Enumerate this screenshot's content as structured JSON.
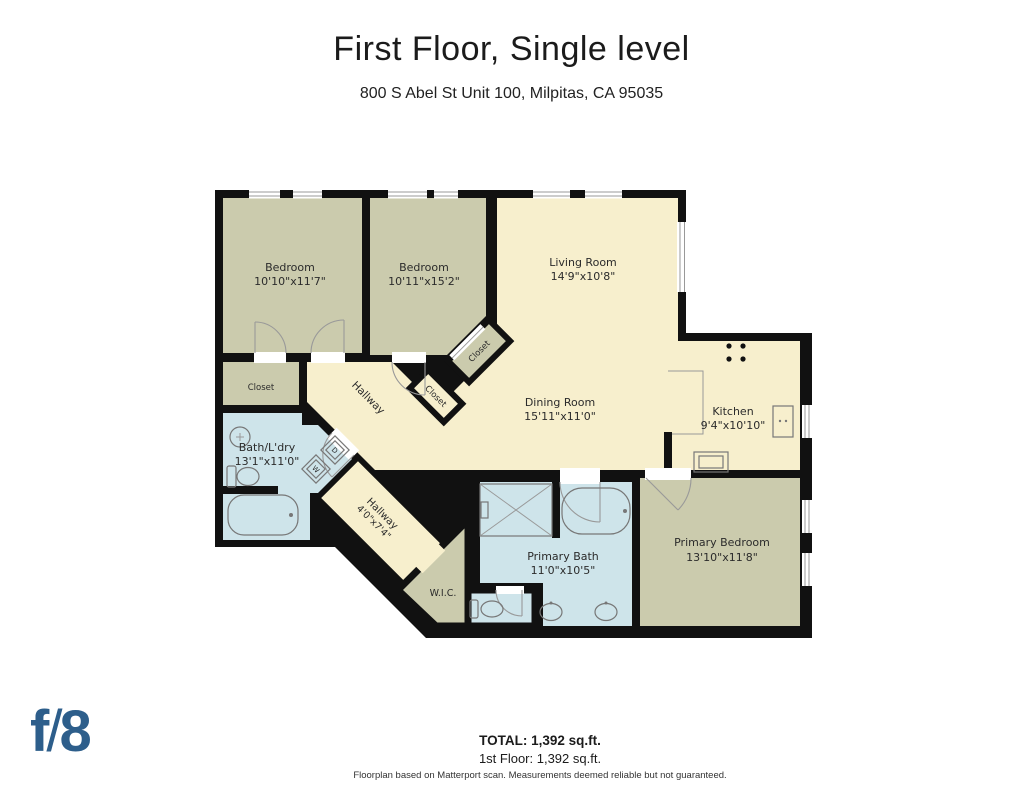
{
  "header": {
    "title": "First Floor, Single level",
    "address": "800 S Abel St Unit 100, Milpitas, CA 95035"
  },
  "rooms": {
    "bedroom1": {
      "name": "Bedroom",
      "dims": "10'10\"x11'7\""
    },
    "bedroom2": {
      "name": "Bedroom",
      "dims": "10'11\"x15'2\""
    },
    "living": {
      "name": "Living Room",
      "dims": "14'9\"x10'8\""
    },
    "dining": {
      "name": "Dining Room",
      "dims": "15'11\"x11'0\""
    },
    "kitchen": {
      "name": "Kitchen",
      "dims": "9'4\"x10'10\""
    },
    "bath_laundry": {
      "name": "Bath/L'dry",
      "dims": "13'1\"x11'0\""
    },
    "hallway_upper": {
      "name": "Hallway"
    },
    "hallway_lower": {
      "name": "Hallway",
      "dims": "4'0\"x7'4\""
    },
    "wic": {
      "name": "W.I.C."
    },
    "primary_bath": {
      "name": "Primary Bath",
      "dims": "11'0\"x10'5\""
    },
    "primary_bedroom": {
      "name": "Primary Bedroom",
      "dims": "13'10\"x11'8\""
    },
    "closet_left": {
      "name": "Closet"
    },
    "closet_a": {
      "name": "Closet"
    },
    "closet_b": {
      "name": "Closet"
    }
  },
  "appliances": {
    "washer": "W",
    "dryer": "D"
  },
  "footer": {
    "total": "TOTAL: 1,392 sq.ft.",
    "floor": "1st Floor: 1,392 sq.ft.",
    "disclaimer": "Floorplan based on Matterport scan. Measurements deemed reliable but not guaranteed."
  },
  "logo": {
    "f": "f",
    "slash": "/",
    "eight": "8"
  },
  "colors": {
    "room_cream": "#f7efcd",
    "room_sage": "#cbcbad",
    "room_bath_blue": "#cee4ea",
    "wall": "#111111",
    "logo_blue": "#2d5e8b"
  }
}
